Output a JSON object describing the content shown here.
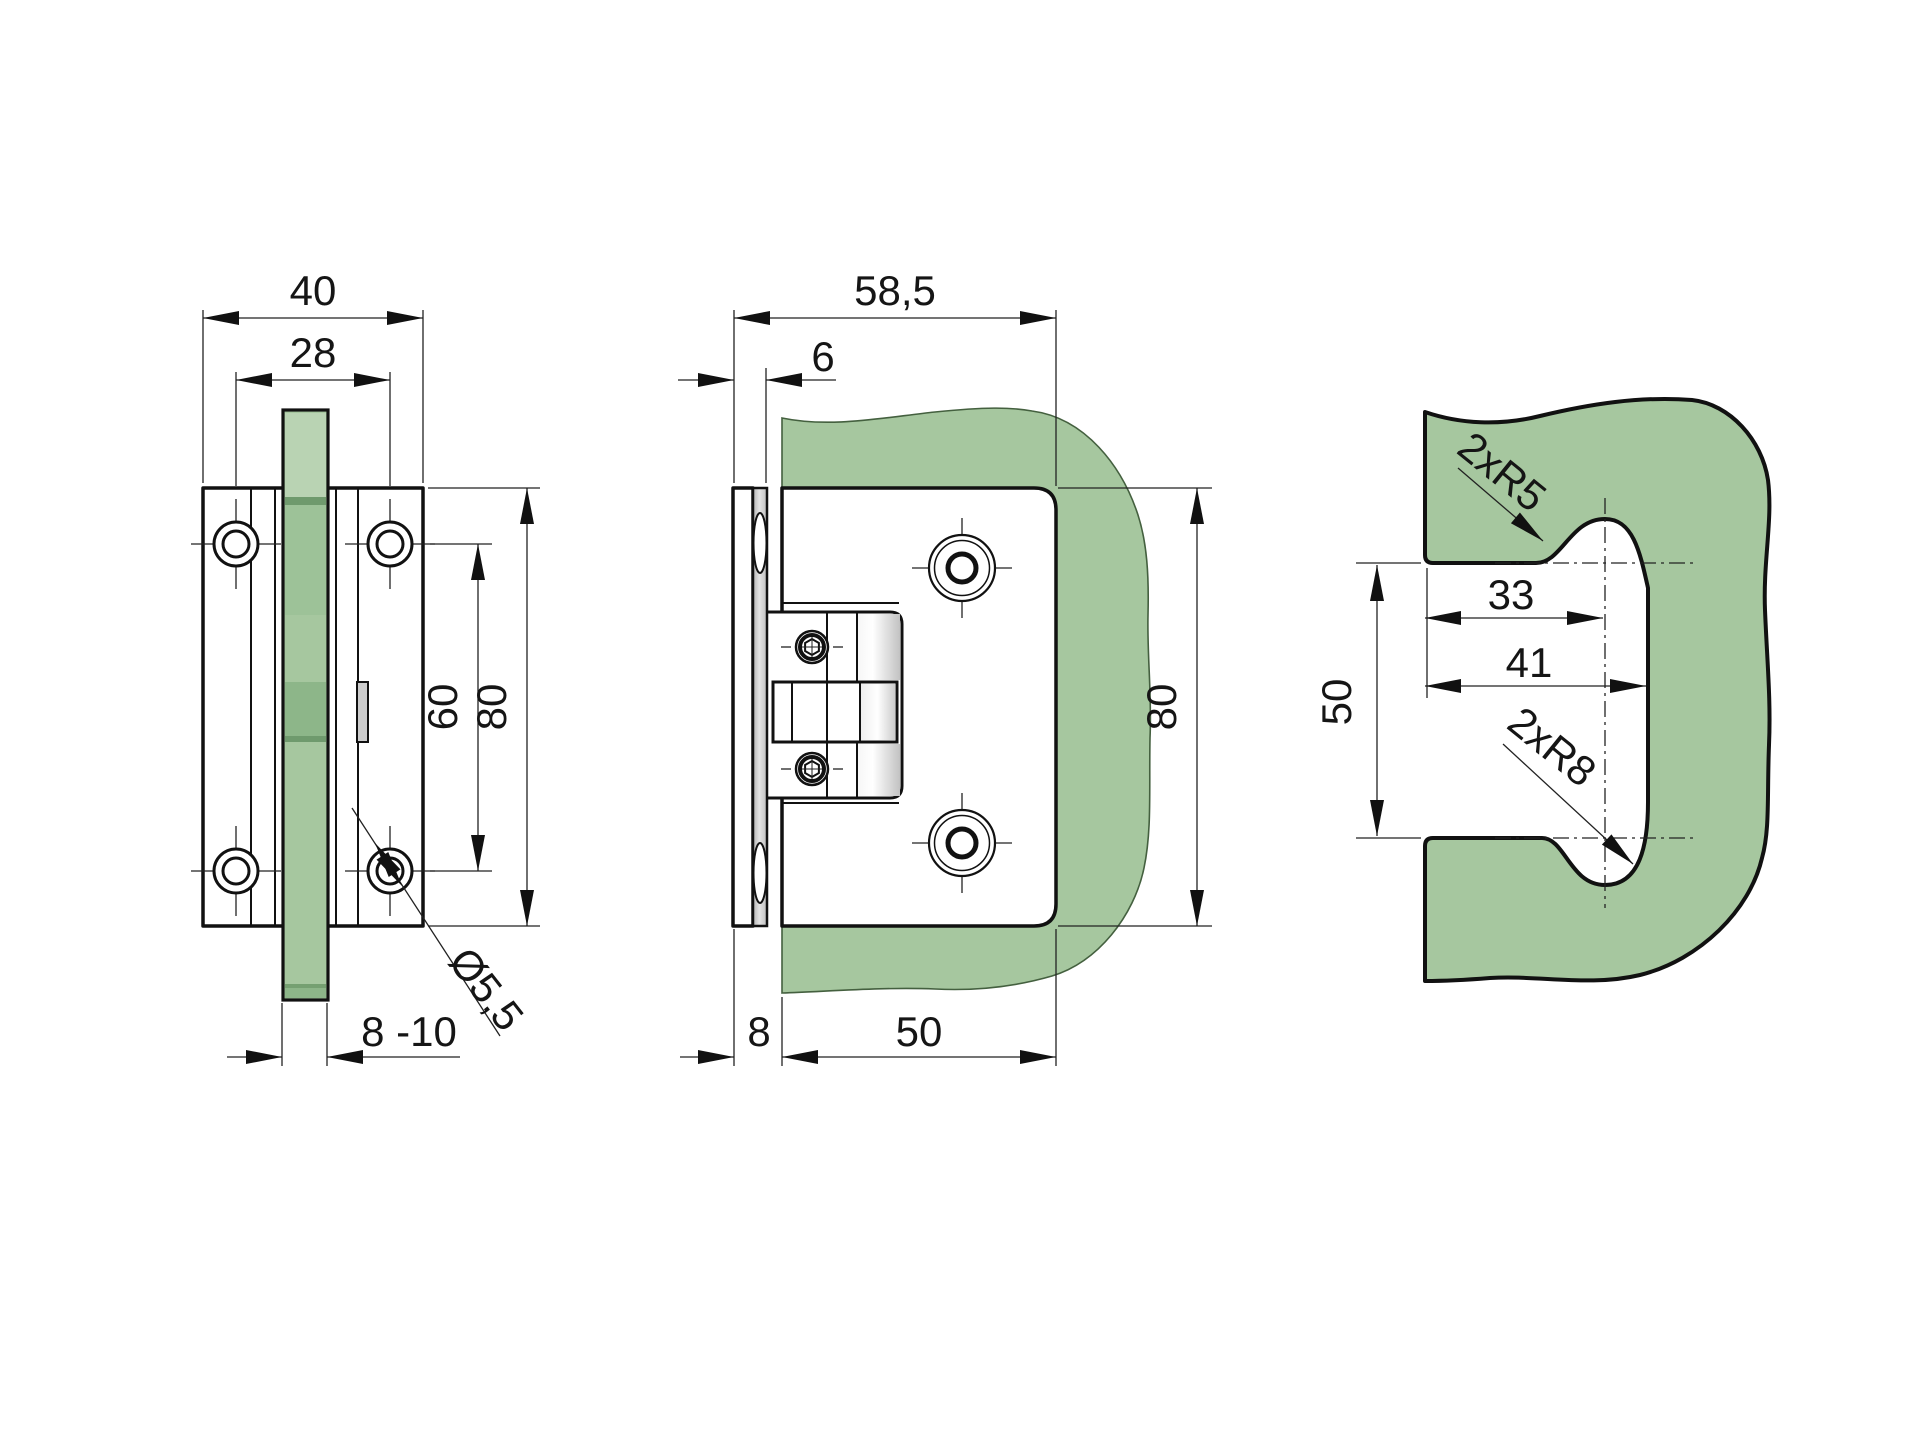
{
  "drawing": {
    "type": "technical-drawing",
    "subject": "glass door hinge with wall plate and glass cutout",
    "colors": {
      "glass": "#a6c79f",
      "glass_light": "#b9d3b3",
      "glass_band": "#8db689",
      "glass_dark": "#6f9a6d",
      "glass_edge_dark": "#75a071",
      "metal_gray": "#c9c9c9",
      "line": "#111111"
    },
    "views": {
      "front": {
        "name": "front view",
        "dims": {
          "body_width": "40",
          "hole_spacing_horizontal": "28",
          "hole_spacing_vertical": "60",
          "body_height": "80",
          "hole_diameter": "Ø5,5",
          "glass_thickness_range": "8 -10"
        }
      },
      "side": {
        "name": "side view",
        "dims": {
          "total_depth": "58,5",
          "wall_plate_thickness": "6",
          "body_height": "80",
          "wall_offset": "8",
          "plate_width": "50"
        }
      },
      "cutout": {
        "name": "glass cutout view",
        "dims": {
          "radius_top": "2xR5",
          "edge_to_axis": "33",
          "cutout_width": "41",
          "cutout_height": "50",
          "radius_bottom": "2xR8"
        }
      }
    }
  }
}
